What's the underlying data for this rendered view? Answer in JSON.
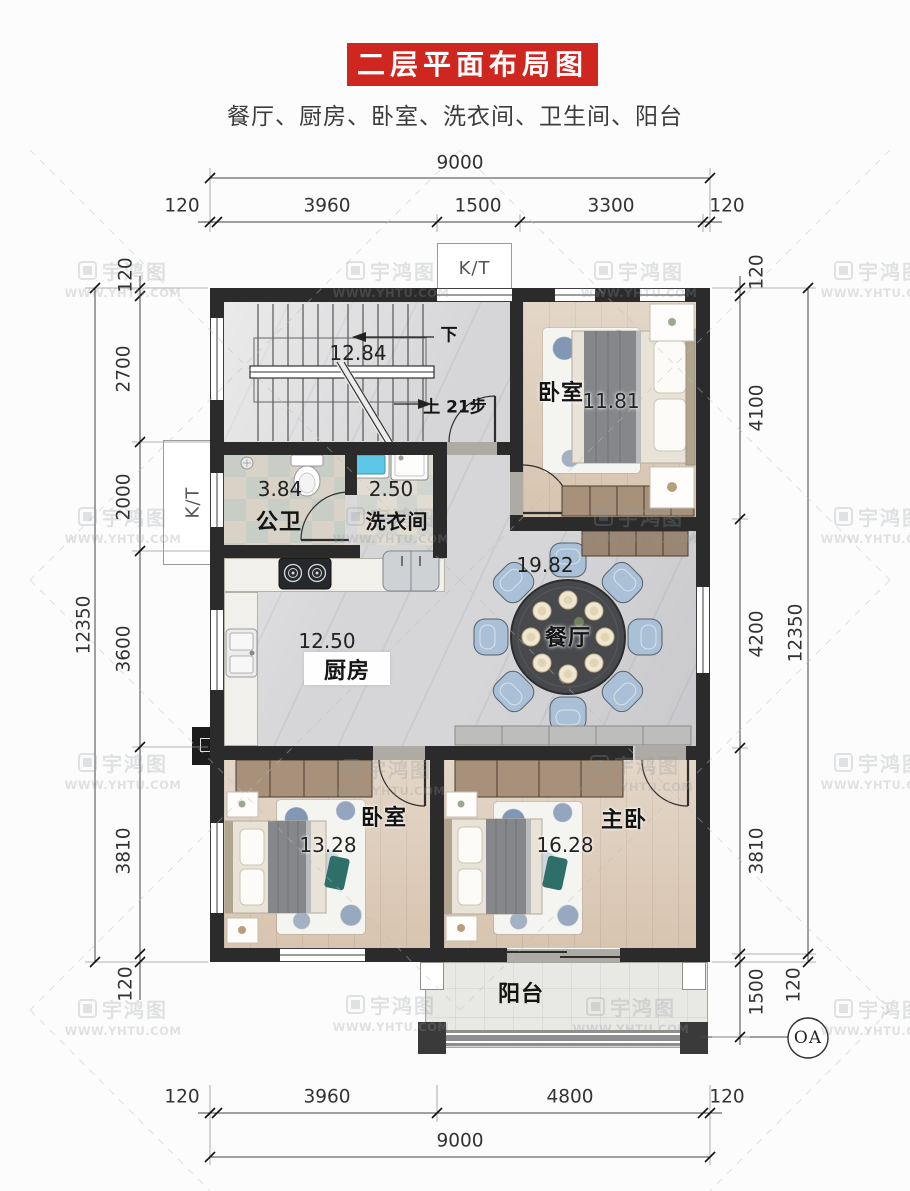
{
  "header": {
    "title": "二层平面布局图",
    "subtitle": "餐厅、厨房、卧室、洗衣间、卫生间、阳台"
  },
  "dimensions": {
    "top": {
      "overall": "9000",
      "segments": [
        "120",
        "3960",
        "1500",
        "3300",
        "120"
      ]
    },
    "bottom": {
      "overall": "9000",
      "segments": [
        "120",
        "3960",
        "4800",
        "120"
      ]
    },
    "left": {
      "overall": "12350",
      "segments": [
        "120",
        "2700",
        "2000",
        "3600",
        "3810",
        "120"
      ]
    },
    "right": {
      "overall": "12350",
      "segments": [
        "120",
        "4100",
        "4200",
        "3810",
        "120"
      ],
      "balcony": "1500"
    }
  },
  "rooms": {
    "stairwell": {
      "area": "12.84",
      "down_label": "下",
      "up_label": "上 21步"
    },
    "bedroom_top": {
      "label": "卧室",
      "area": "11.81"
    },
    "bathroom": {
      "label": "公卫",
      "area": "3.84"
    },
    "laundry": {
      "label": "洗衣间",
      "area": "2.50"
    },
    "dining": {
      "label": "餐厅",
      "area": "19.82"
    },
    "kitchen": {
      "label": "厨房",
      "area": "12.50"
    },
    "bedroom_left": {
      "label": "卧室",
      "area": "13.28"
    },
    "master_bedroom": {
      "label": "主卧",
      "area": "16.28"
    },
    "balcony": {
      "label": "阳台"
    }
  },
  "annotations": {
    "kt_top": "K/T",
    "kt_side": "K/T",
    "axis_bubble": "OA"
  },
  "watermark": {
    "name": "宇鸿图",
    "url": "WWW.YHTU.COM"
  },
  "colors": {
    "banner_red": "#d02620",
    "wall": "#2b2b2b",
    "wood_floor": "#dccbb8",
    "marble_floor": "#d6d6d8",
    "chair_blue": "#a9c0d6",
    "wardrobe_brown": "#a8917a"
  }
}
